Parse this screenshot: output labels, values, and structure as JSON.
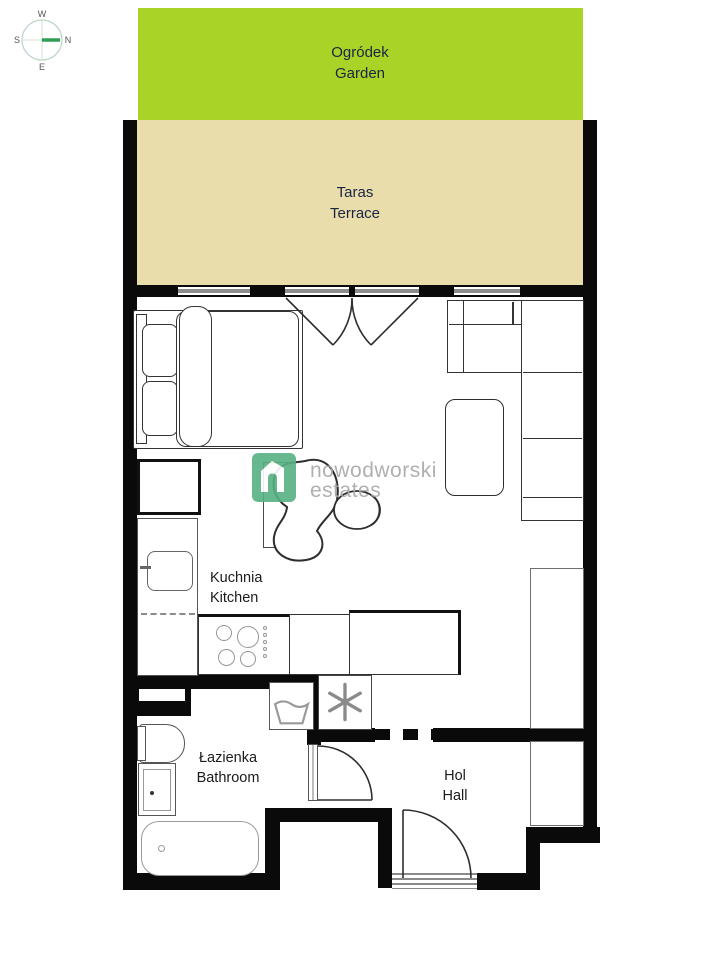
{
  "plan": {
    "garden": {
      "name_pl": "Ogródek",
      "name_en": "Garden",
      "bg": "#a9d327"
    },
    "terrace": {
      "name_pl": "Taras",
      "name_en": "Terrace",
      "bg": "#e8ddab"
    },
    "kitchen": {
      "name_pl": "Kuchnia",
      "name_en": "Kitchen"
    },
    "bathroom": {
      "name_pl": "Łazienka",
      "name_en": "Bathroom"
    },
    "hall": {
      "name_pl": "Hol",
      "name_en": "Hall"
    }
  },
  "compass": {
    "north": "N",
    "south": "S",
    "east": "E",
    "west": "W",
    "needle_color": "#2f9e54"
  },
  "watermark": {
    "brand_line1": "nowodworski",
    "brand_line2": "estates",
    "logo_color": "#57b183",
    "text_color": "#a8a8a8"
  },
  "colors": {
    "wall": "#0a0a0a",
    "window_glass": "#8c8c8c",
    "area_label": "#1c2444"
  }
}
